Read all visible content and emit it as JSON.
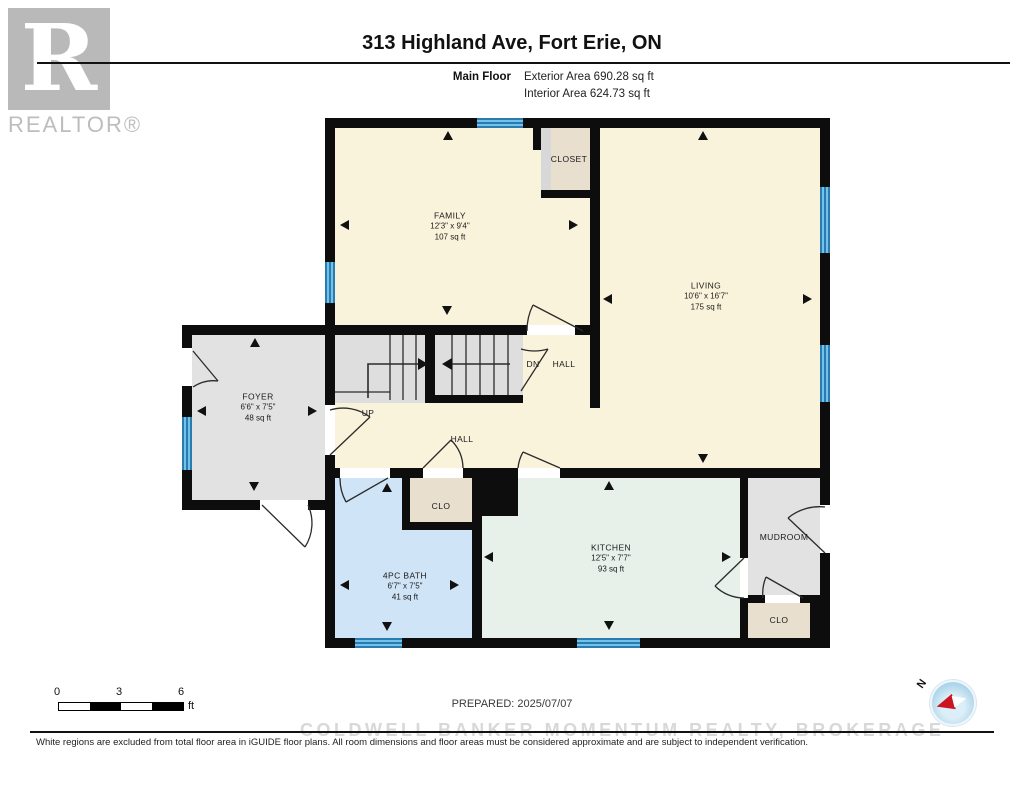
{
  "logo": {
    "letter": "R",
    "label": "REALTOR®"
  },
  "header": {
    "title": "313 Highland Ave, Fort Erie, ON",
    "floor_label": "Main Floor",
    "exterior_area": "Exterior Area 690.28 sq ft",
    "interior_area": "Interior Area 624.73 sq ft"
  },
  "rooms": {
    "family": {
      "name": "FAMILY",
      "dims": "12'3\" x 9'4\"",
      "area": "107 sq ft"
    },
    "closet": {
      "name": "CLOSET"
    },
    "living": {
      "name": "LIVING",
      "dims": "10'6\" x 16'7\"",
      "area": "175 sq ft"
    },
    "foyer": {
      "name": "FOYER",
      "dims": "6'6\" x 7'5\"",
      "area": "48 sq ft"
    },
    "hall": {
      "name": "HALL"
    },
    "dn_hall": {
      "tag": "DN",
      "name": "HALL"
    },
    "up_label": "UP",
    "clo_hall": {
      "name": "CLO"
    },
    "bath": {
      "name": "4PC BATH",
      "dims": "6'7\" x 7'5\"",
      "area": "41 sq ft"
    },
    "kitchen": {
      "name": "KITCHEN",
      "dims": "12'5\" x 7'7\"",
      "area": "93 sq ft"
    },
    "mudroom": {
      "name": "MUDROOM"
    },
    "clo_mud": {
      "name": "CLO"
    }
  },
  "scale_bar": {
    "tick0": "0",
    "tick3": "3",
    "tick6": "6",
    "unit": "ft"
  },
  "compass": {
    "north_label": "N"
  },
  "footer": {
    "prepared": "PREPARED: 2025/07/07",
    "watermark": "COLDWELL BANKER MOMENTUM REALTY, BROKERAGE",
    "disclaimer": "White regions are excluded from total floor area in iGUIDE floor plans. All room dimensions and floor areas must be considered approximate and are subject to independent verification."
  },
  "colors": {
    "wall": "#0d0d0d",
    "interior_room": "#faf3dc",
    "excluded_room": "#e2e2e2",
    "closet": "#e8dfcf",
    "bath": "#cfe4f6",
    "kitchen": "#e7f1ea",
    "window": "#4aa9da",
    "compass_red": "#cc1322"
  }
}
